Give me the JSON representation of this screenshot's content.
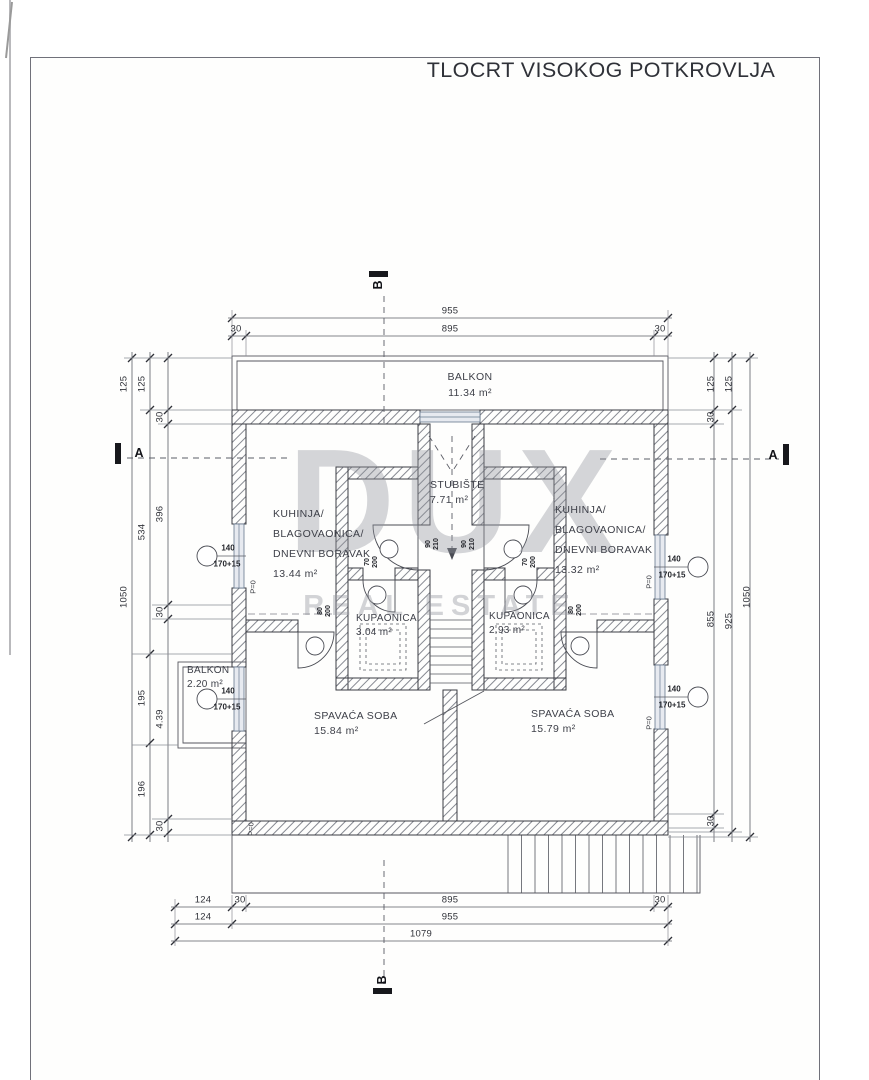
{
  "title": "TLOCRT VISOKOG POTKROVLJA",
  "watermark": {
    "brand": "DUX",
    "tagline": "REAL ESTATE"
  },
  "rooms": [
    {
      "name": "BALKON",
      "area": "11.34 m²"
    },
    {
      "name": "KUHINJA/BLAGOVAONICA/DNEVNI BORAVAK",
      "area": "13.44 m²"
    },
    {
      "name": "KUHINJA/BLAGOVAONICA/DNEVNI BORAVAK",
      "area": "13.32 m²"
    },
    {
      "name": "STUBIŠTE",
      "area": "7.71 m²"
    },
    {
      "name": "KUPAONICA",
      "area": "3.04 m²"
    },
    {
      "name": "KUPAONICA",
      "area": "2.93 m²"
    },
    {
      "name": "SPAVAĆA SOBA",
      "area": "15.84 m²"
    },
    {
      "name": "SPAVAĆA SOBA",
      "area": "15.79 m²"
    },
    {
      "name": "BALKON",
      "area": "2.20 m²"
    }
  ],
  "labels": [
    {
      "kind": "room",
      "name": "room-label-balkon-top",
      "x": 470,
      "y": 385,
      "lh": 16,
      "lines": [
        "BALKON",
        "11.34 m²"
      ]
    },
    {
      "kind": "room",
      "name": "room-label-kitchen-left",
      "a": "tl",
      "x": 273,
      "y": 504,
      "lh": 20,
      "lines": [
        "KUHINJA/",
        "BLAGOVAONICA/",
        "DNEVNI BORAVAK",
        "13.44 m²"
      ]
    },
    {
      "kind": "room",
      "name": "room-label-kitchen-right",
      "a": "tl",
      "x": 555,
      "y": 500,
      "lh": 20,
      "lines": [
        "KUHINJA/",
        "BLAGOVAONICA/",
        "DNEVNI BORAVAK",
        "13.32 m²"
      ]
    },
    {
      "kind": "room",
      "name": "room-label-staircase",
      "a": "tl",
      "x": 430,
      "y": 478,
      "lines": [
        "STUBIŠTE",
        "7.71 m²"
      ]
    },
    {
      "kind": "room-sm",
      "name": "room-label-bathroom-left",
      "a": "tl",
      "x": 356,
      "y": 612,
      "lines": [
        "KUPAONICA",
        "3.04 m²"
      ]
    },
    {
      "kind": "room-sm",
      "name": "room-label-bathroom-right",
      "a": "tl",
      "x": 489,
      "y": 610,
      "lines": [
        "KUPAONICA",
        "2.93 m²"
      ]
    },
    {
      "kind": "room",
      "name": "room-label-bedroom-left",
      "a": "tl",
      "x": 314,
      "y": 709,
      "lines": [
        "SPAVAĆA SOBA",
        "15.84 m²"
      ]
    },
    {
      "kind": "room",
      "name": "room-label-bedroom-right",
      "a": "tl",
      "x": 531,
      "y": 707,
      "lines": [
        "SPAVAĆA SOBA",
        "15.79 m²"
      ]
    },
    {
      "kind": "room-sm",
      "name": "room-label-balkon-small",
      "a": "tl",
      "x": 187,
      "y": 664,
      "lines": [
        "BALKON",
        "2.20 m²"
      ]
    },
    {
      "kind": "dim",
      "x": 450,
      "y": 311,
      "lines": [
        "955"
      ]
    },
    {
      "kind": "dim",
      "x": 450,
      "y": 329,
      "lines": [
        "895"
      ]
    },
    {
      "kind": "dim",
      "x": 236,
      "y": 329,
      "lines": [
        "30"
      ]
    },
    {
      "kind": "dim",
      "x": 660,
      "y": 329,
      "lines": [
        "30"
      ]
    },
    {
      "kind": "dim",
      "x": 203,
      "y": 900,
      "lines": [
        "124"
      ]
    },
    {
      "kind": "dim",
      "x": 240,
      "y": 900,
      "lines": [
        "30"
      ]
    },
    {
      "kind": "dim",
      "x": 450,
      "y": 900,
      "lines": [
        "895"
      ]
    },
    {
      "kind": "dim",
      "x": 660,
      "y": 900,
      "lines": [
        "30"
      ]
    },
    {
      "kind": "dim",
      "x": 203,
      "y": 917,
      "lines": [
        "124"
      ]
    },
    {
      "kind": "dim",
      "x": 450,
      "y": 917,
      "lines": [
        "955"
      ]
    },
    {
      "kind": "dim",
      "x": 421,
      "y": 934,
      "lines": [
        "1079"
      ]
    },
    {
      "kind": "dim",
      "rot": -90,
      "x": 124,
      "y": 384,
      "lines": [
        "125"
      ]
    },
    {
      "kind": "dim",
      "rot": -90,
      "x": 142,
      "y": 384,
      "lines": [
        "125"
      ]
    },
    {
      "kind": "dim",
      "rot": -90,
      "x": 160,
      "y": 417,
      "lines": [
        "30"
      ]
    },
    {
      "kind": "dim",
      "rot": -90,
      "x": 160,
      "y": 514,
      "lines": [
        "396"
      ]
    },
    {
      "kind": "dim",
      "rot": -90,
      "x": 142,
      "y": 532,
      "lines": [
        "534"
      ]
    },
    {
      "kind": "dim",
      "rot": -90,
      "x": 124,
      "y": 597,
      "lines": [
        "1050"
      ]
    },
    {
      "kind": "dim",
      "rot": -90,
      "x": 160,
      "y": 612,
      "lines": [
        "30"
      ]
    },
    {
      "kind": "dim",
      "rot": -90,
      "x": 142,
      "y": 698,
      "lines": [
        "195"
      ]
    },
    {
      "kind": "dim",
      "rot": -90,
      "x": 160,
      "y": 719,
      "lines": [
        "4.39"
      ]
    },
    {
      "kind": "dim",
      "rot": -90,
      "x": 142,
      "y": 789,
      "lines": [
        "196"
      ]
    },
    {
      "kind": "dim",
      "rot": -90,
      "x": 160,
      "y": 826,
      "lines": [
        "30"
      ]
    },
    {
      "kind": "dim",
      "rot": -90,
      "x": 711,
      "y": 384,
      "lines": [
        "125"
      ]
    },
    {
      "kind": "dim",
      "rot": -90,
      "x": 729,
      "y": 384,
      "lines": [
        "125"
      ]
    },
    {
      "kind": "dim",
      "rot": -90,
      "x": 711,
      "y": 417,
      "lines": [
        "30"
      ]
    },
    {
      "kind": "dim",
      "rot": -90,
      "x": 711,
      "y": 619,
      "lines": [
        "855"
      ]
    },
    {
      "kind": "dim",
      "rot": -90,
      "x": 729,
      "y": 621,
      "lines": [
        "925"
      ]
    },
    {
      "kind": "dim",
      "rot": -90,
      "x": 747,
      "y": 597,
      "lines": [
        "1050"
      ]
    },
    {
      "kind": "dim",
      "rot": -90,
      "x": 711,
      "y": 821,
      "lines": [
        "30"
      ]
    },
    {
      "kind": "win",
      "x": 228,
      "y": 548,
      "lines": [
        "140"
      ]
    },
    {
      "kind": "win",
      "x": 227,
      "y": 564,
      "lines": [
        "170+15"
      ]
    },
    {
      "kind": "win",
      "x": 228,
      "y": 691,
      "lines": [
        "140"
      ]
    },
    {
      "kind": "win",
      "x": 227,
      "y": 707,
      "lines": [
        "170+15"
      ]
    },
    {
      "kind": "win",
      "x": 674,
      "y": 559,
      "lines": [
        "140"
      ]
    },
    {
      "kind": "win",
      "x": 672,
      "y": 575,
      "lines": [
        "170+15"
      ]
    },
    {
      "kind": "win",
      "x": 674,
      "y": 689,
      "lines": [
        "140"
      ]
    },
    {
      "kind": "win",
      "x": 672,
      "y": 705,
      "lines": [
        "170+15"
      ]
    },
    {
      "kind": "door",
      "rot": -90,
      "x": 433,
      "y": 544,
      "lines": [
        "90",
        "210"
      ]
    },
    {
      "kind": "door",
      "rot": -90,
      "x": 469,
      "y": 544,
      "lines": [
        "90",
        "210"
      ]
    },
    {
      "kind": "door",
      "rot": -90,
      "x": 372,
      "y": 562,
      "lines": [
        "70",
        "200"
      ]
    },
    {
      "kind": "door",
      "rot": -90,
      "x": 530,
      "y": 562,
      "lines": [
        "70",
        "200"
      ]
    },
    {
      "kind": "door",
      "rot": -90,
      "x": 325,
      "y": 611,
      "lines": [
        "80",
        "200"
      ]
    },
    {
      "kind": "door",
      "rot": -90,
      "x": 576,
      "y": 610,
      "lines": [
        "80",
        "200"
      ]
    },
    {
      "kind": "pz",
      "rot": -90,
      "x": 253,
      "y": 587,
      "lines": [
        "P=0"
      ]
    },
    {
      "kind": "pz",
      "rot": -90,
      "x": 251,
      "y": 829,
      "lines": [
        "P=0"
      ]
    },
    {
      "kind": "pz",
      "rot": -90,
      "x": 649,
      "y": 582,
      "lines": [
        "P=0"
      ]
    },
    {
      "kind": "pz",
      "rot": -90,
      "x": 649,
      "y": 723,
      "lines": [
        "P=0"
      ]
    },
    {
      "kind": "sec",
      "name": "section-marker-a-left",
      "x": 139,
      "y": 453,
      "lines": [
        "A"
      ]
    },
    {
      "kind": "sec",
      "name": "section-marker-a-right",
      "x": 773,
      "y": 455,
      "lines": [
        "A"
      ]
    },
    {
      "kind": "sec",
      "name": "section-marker-b-top",
      "rot": -90,
      "x": 378,
      "y": 285,
      "lines": [
        "B"
      ]
    },
    {
      "kind": "sec",
      "name": "section-marker-b-bottom",
      "rot": -90,
      "x": 382,
      "y": 980,
      "lines": [
        "B"
      ]
    }
  ]
}
